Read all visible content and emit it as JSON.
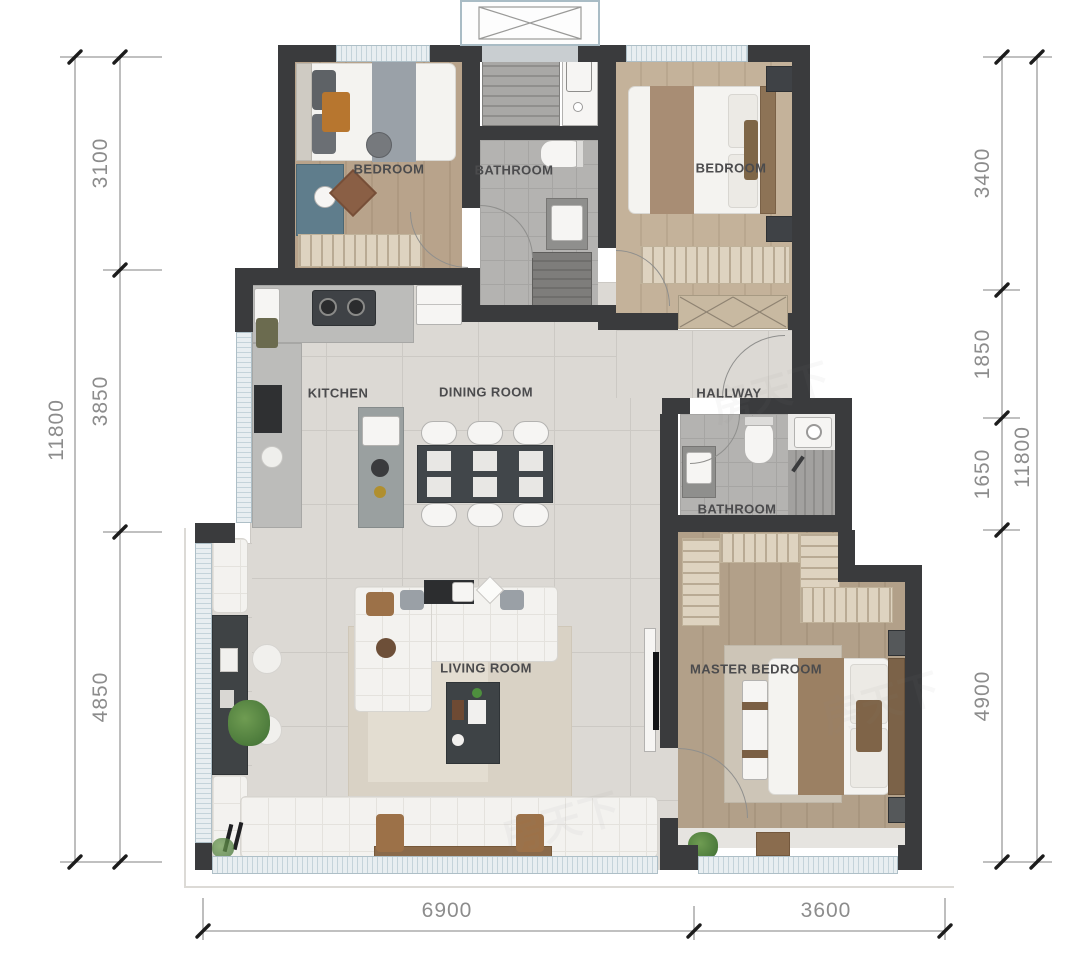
{
  "title": "apartment-floor-plan",
  "rooms": [
    {
      "id": "bedroom-1",
      "label": "BEDROOM"
    },
    {
      "id": "bathroom-1",
      "label": "BATHROOM"
    },
    {
      "id": "bedroom-2",
      "label": "BEDROOM"
    },
    {
      "id": "kitchen",
      "label": "KITCHEN"
    },
    {
      "id": "dining-room",
      "label": "DINING ROOM"
    },
    {
      "id": "hallway",
      "label": "HALLWAY"
    },
    {
      "id": "bathroom-2",
      "label": "BATHROOM"
    },
    {
      "id": "living-room",
      "label": "LIVING ROOM"
    },
    {
      "id": "master-bedroom",
      "label": "MASTER BEDROOM"
    }
  ],
  "dimensions": {
    "left_total": "11800",
    "left_chain": [
      "3100",
      "3850",
      "4850"
    ],
    "right_chain": [
      "3400",
      "1850",
      "1650",
      "4900"
    ],
    "right_total": "11800",
    "bottom_chain": [
      "6900",
      "3600"
    ]
  },
  "watermark": "房天下",
  "colors": {
    "wall": "#3a3b3d",
    "dim_line": "#9b9b9b",
    "dim_text": "#8c8c8c",
    "label_text": "#4b4b4d",
    "wood_floor": "#b2a089",
    "tile_floor": "#dcd9d4",
    "window": "#e8eef1"
  }
}
